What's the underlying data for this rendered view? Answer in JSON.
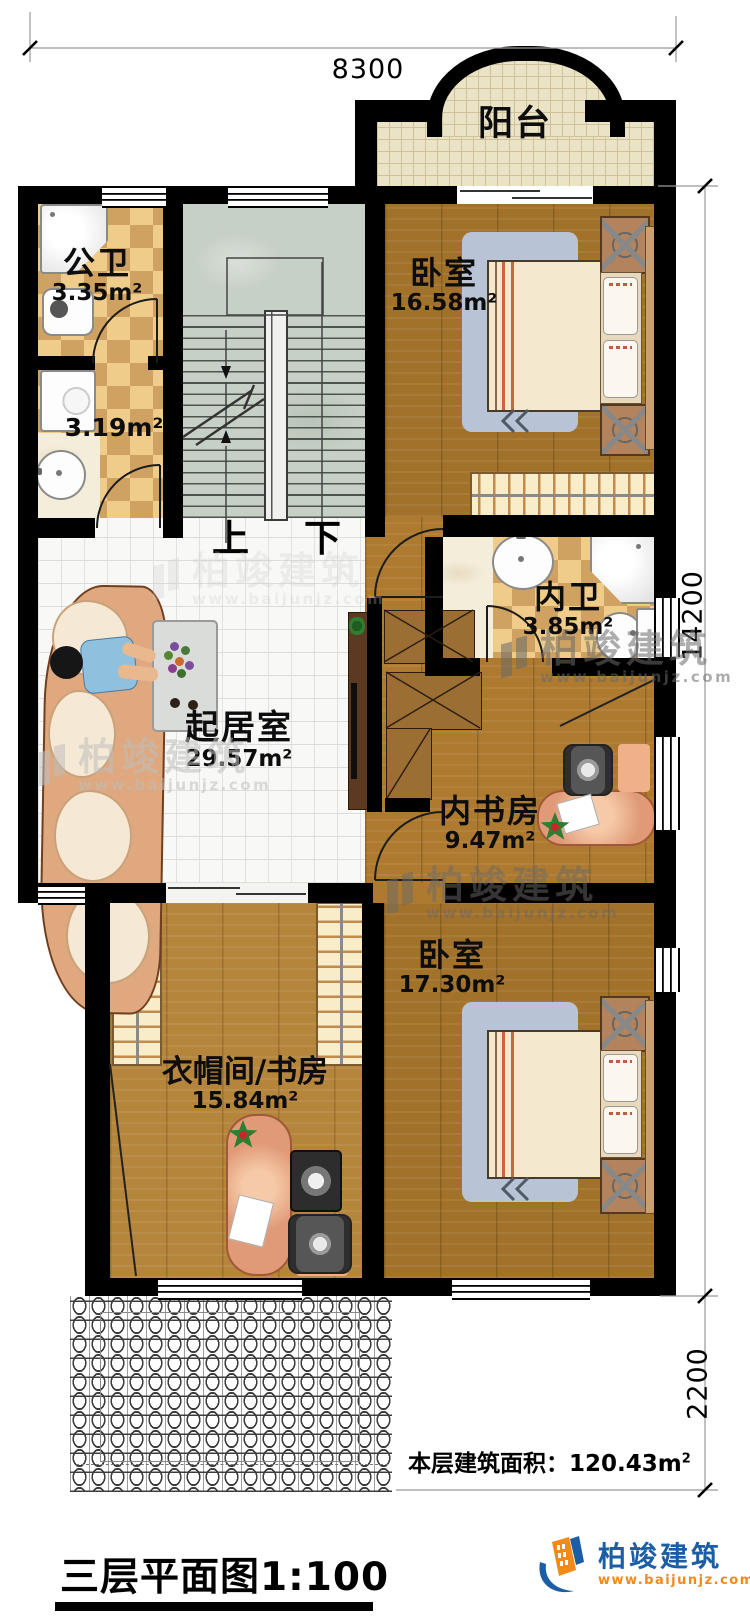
{
  "plan": {
    "balcony": {
      "name": "阳台"
    },
    "rooms": [
      {
        "key": "public-bath",
        "name": "公卫",
        "area": "3.35m²"
      },
      {
        "key": "laundry",
        "name": "",
        "area": "3.19m²"
      },
      {
        "key": "bedroom-top",
        "name": "卧室",
        "area": "16.58m²"
      },
      {
        "key": "ensuite-bath",
        "name": "内卫",
        "area": "3.85m²"
      },
      {
        "key": "living-room",
        "name": "起居室",
        "area": "29.57m²"
      },
      {
        "key": "inner-study",
        "name": "内书房",
        "area": "9.47m²"
      },
      {
        "key": "bedroom-bottom",
        "name": "卧室",
        "area": "17.30m²"
      },
      {
        "key": "cloakroom-study",
        "name": "衣帽间/书房",
        "area": "15.84m²"
      }
    ],
    "stairs": {
      "up": "上",
      "down": "下"
    },
    "dimensions": {
      "top": "8300",
      "right_upper": "14200",
      "right_lower": "2200"
    }
  },
  "footer": {
    "area_text": "本层建筑面积：120.43m",
    "area_sup": "2",
    "title": "三层平面图1:100"
  },
  "brand": {
    "name": "柏竣建筑",
    "url": "www.baijunjz.com"
  },
  "watermark": {
    "name": "柏竣建筑",
    "url": "www.baijunjz.com"
  },
  "colors": {
    "wall": "#000000",
    "wood_floor": "#ad7a2f",
    "living_tile": "#f8f8f6",
    "stair_floor": "#c7d0c6",
    "checker_light": "#f0cc8a",
    "checker_dark": "#cfa261",
    "balcony_floor": "#ebe3c6",
    "brand_blue": "#1b5ea6",
    "brand_orange": "#f28a1b"
  }
}
